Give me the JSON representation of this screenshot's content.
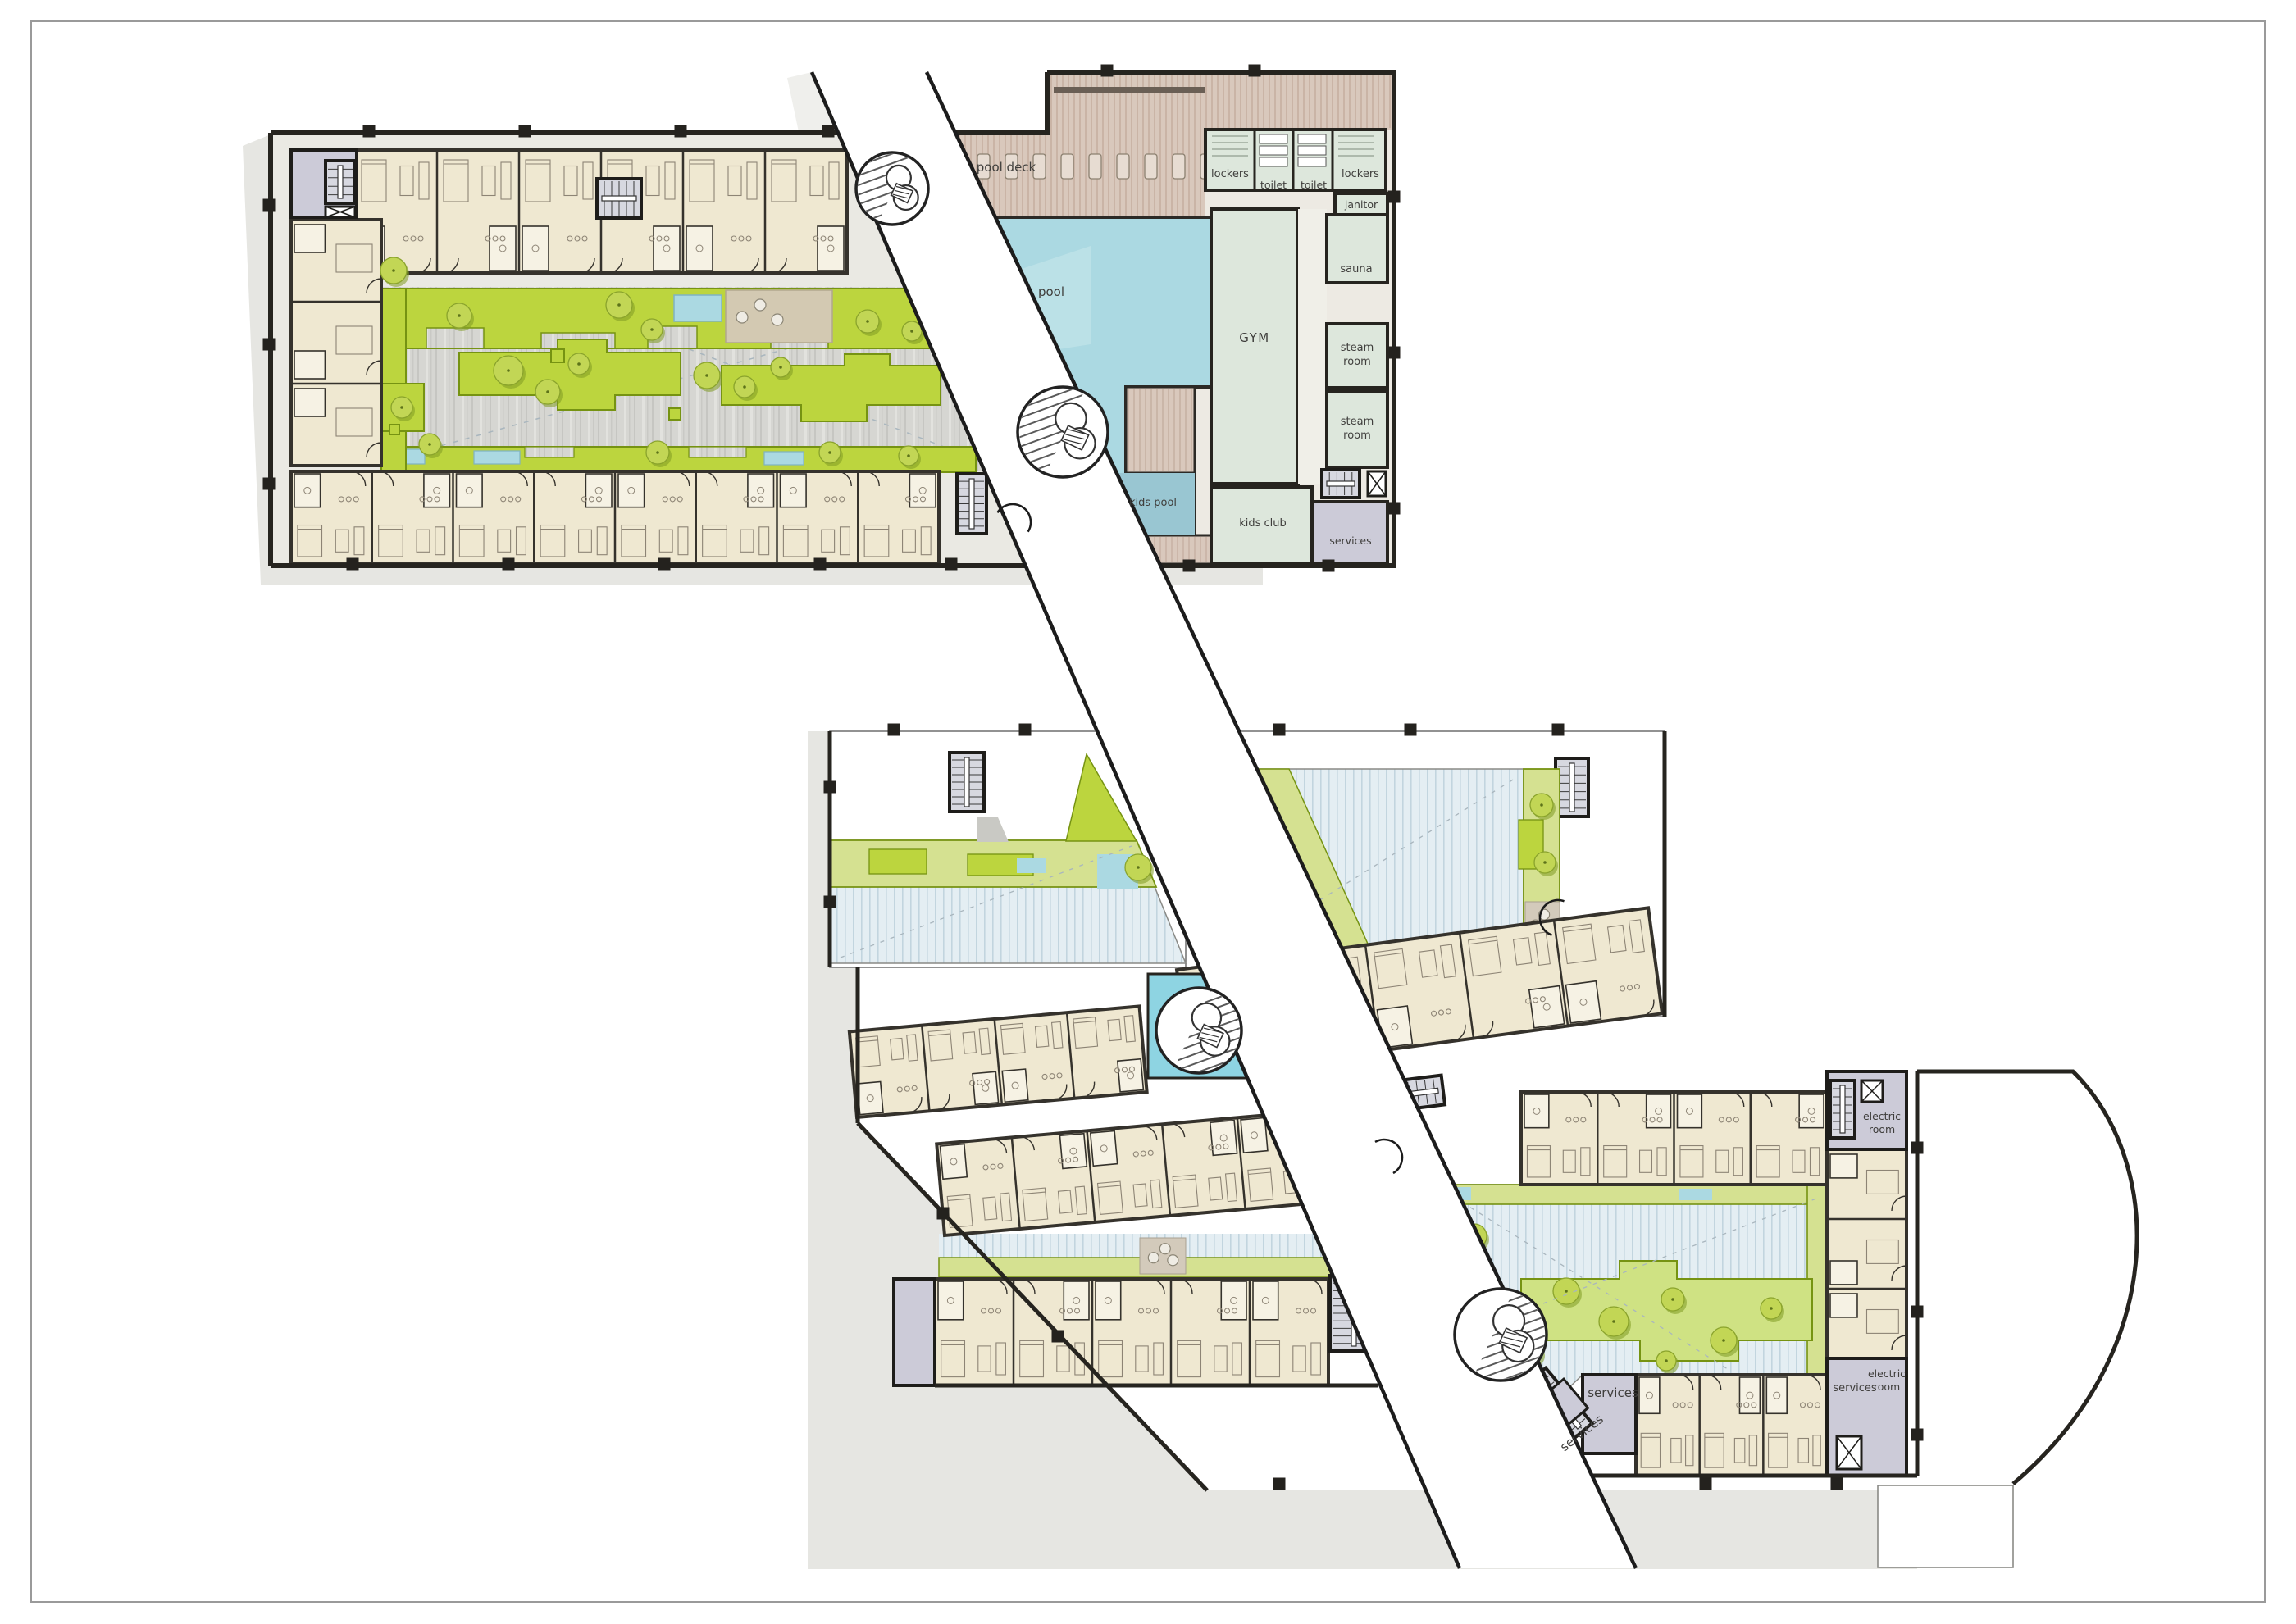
{
  "document": {
    "type": "architectural floor plan",
    "description": "Resort / residential complex ground floor plan: two apartment buildings around landscaped courtyards, linked by a diagonal pedestrian walkway, with pool and wellness amenities"
  },
  "top_building": {
    "rooms": {
      "pool_deck": "pool deck",
      "pool": "pool",
      "kids_pool": "kids pool",
      "gym": "GYM",
      "sauna": "sauna",
      "steam_line1": "steam",
      "steam_line2": "room",
      "lockers": "lockers",
      "toilet": "toilet",
      "janitor": "janitor",
      "kids_club": "kids club",
      "services": "services"
    }
  },
  "bottom_building": {
    "rooms": {
      "services": "services",
      "electric_line1": "electric",
      "electric_line2": "room"
    }
  },
  "palette": {
    "walls": "#2c2a26",
    "apartment_fill": "#efe8d1",
    "apartment_wall": "#35322c",
    "amenity_fill": "#dde7dc",
    "utility_fill": "#cccbd8",
    "pool_blue": "#abd9e2",
    "kids_pool_blue": "#99c6d2",
    "bright_pool_blue": "#8ed4e2",
    "deck_tan": "#d9c8bc",
    "lime_green": "#bcd53e",
    "lime_dark": "#769312",
    "pale_planter": "#d5e191",
    "courtyard_wood": "#d6d6d2",
    "courtyard_blue_deck": "#e4eef3",
    "walkway_white": "#ffffff",
    "plaza_shadow": "#e6e6e2",
    "furniture_line": "#8d8475",
    "label": "#3f3e3c",
    "page_border": "#9a9a9a"
  }
}
